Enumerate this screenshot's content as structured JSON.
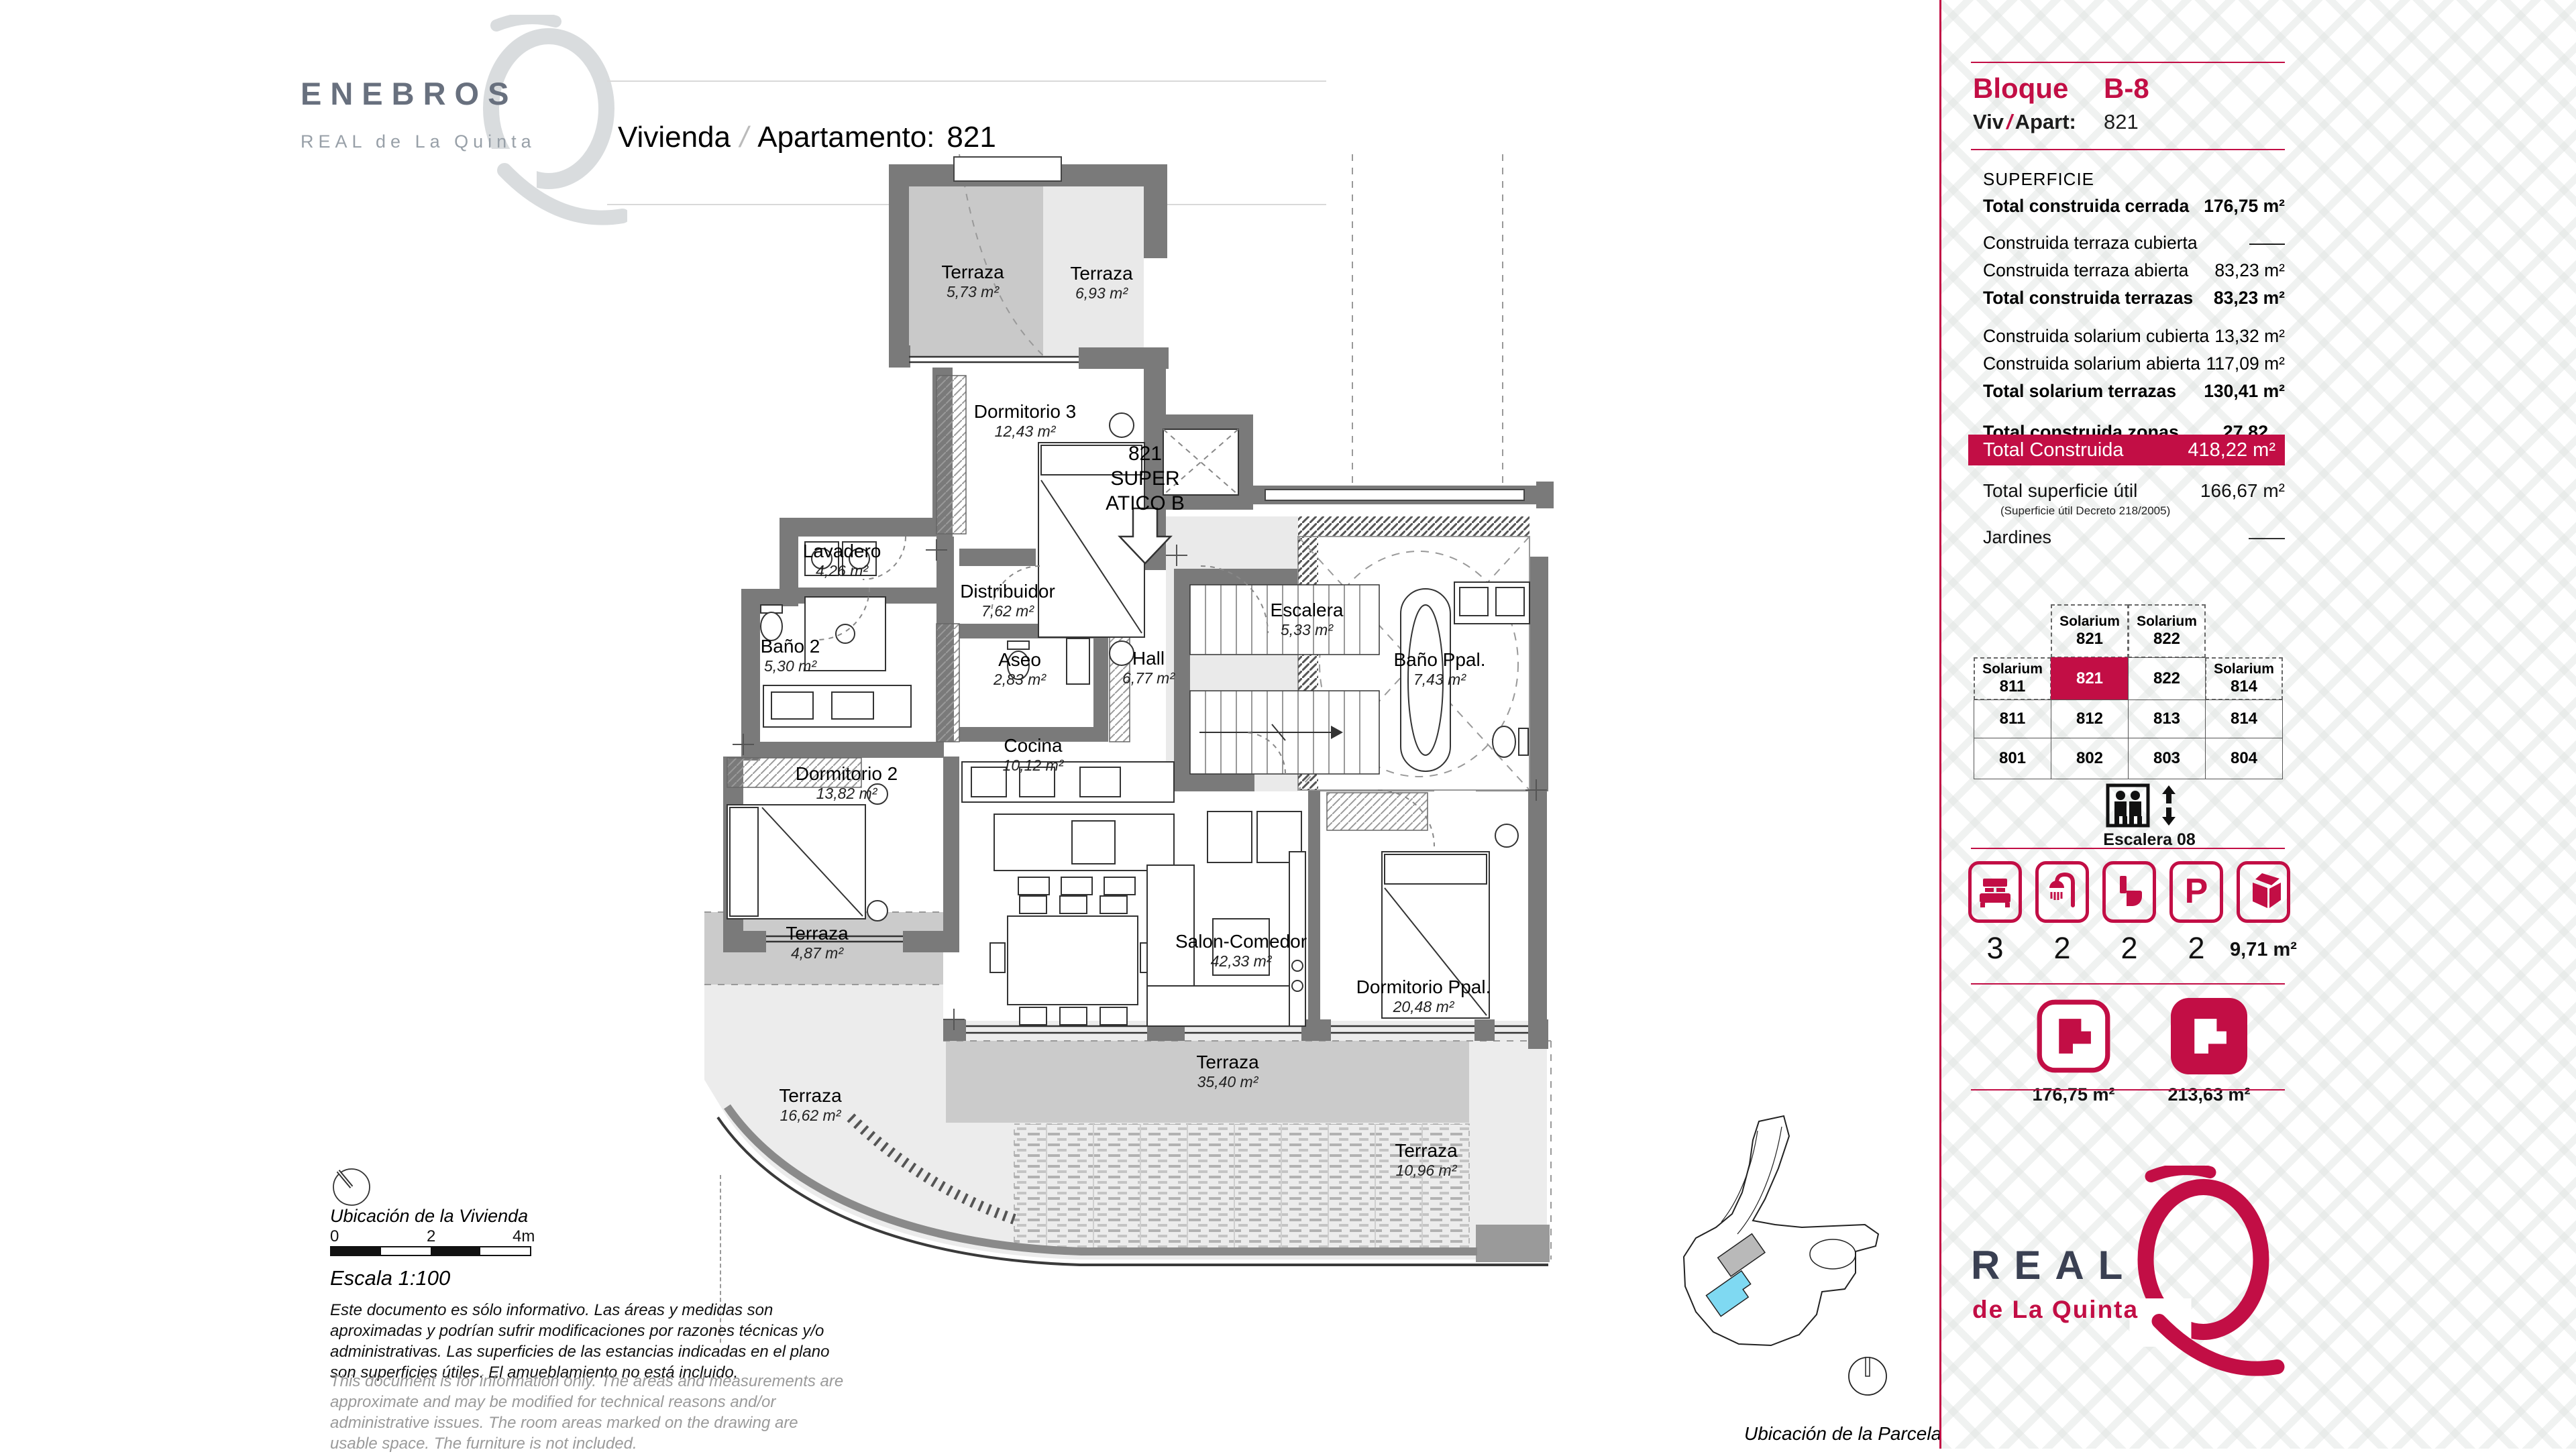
{
  "colors": {
    "accent": "#C20E45",
    "navy": "#3A4052",
    "slate": "#68707E",
    "cyan": "#7FD9F2"
  },
  "brand": {
    "name": "ENEBROS",
    "sub": "REAL de La Quinta"
  },
  "title": {
    "part1": "Vivienda",
    "sep": "/",
    "part2": "Apartamento:",
    "number": "821"
  },
  "plan": {
    "atico": {
      "line1": "821",
      "line2": "SUPER",
      "line3": "ATICO B"
    },
    "rooms": [
      {
        "id": "terraza_573",
        "name": "Terraza",
        "area": "5,73 m²"
      },
      {
        "id": "terraza_693",
        "name": "Terraza",
        "area": "6,93 m²"
      },
      {
        "id": "dormitorio3",
        "name": "Dormitorio 3",
        "area": "12,43 m²"
      },
      {
        "id": "lavadero",
        "name": "Lavadero",
        "area": "4,26 m²"
      },
      {
        "id": "distribuidor",
        "name": "Distribuidor",
        "area": "7,62 m²"
      },
      {
        "id": "bano2",
        "name": "Baño 2",
        "area": "5,30 m²"
      },
      {
        "id": "aseo",
        "name": "Aseo",
        "area": "2,83 m²"
      },
      {
        "id": "hall",
        "name": "Hall",
        "area": "6,77 m²"
      },
      {
        "id": "escalera",
        "name": "Escalera",
        "area": "5,33 m²"
      },
      {
        "id": "bano_ppal",
        "name": "Baño Ppal.",
        "area": "7,43 m²"
      },
      {
        "id": "dormitorio2",
        "name": "Dormitorio 2",
        "area": "13,82 m²"
      },
      {
        "id": "cocina",
        "name": "Cocina",
        "area": "10,12 m²"
      },
      {
        "id": "salon",
        "name": "Salon-Comedor",
        "area": "42,33 m²"
      },
      {
        "id": "dormitorio_ppal",
        "name": "Dormitorio Ppal.",
        "area": "20,48 m²"
      },
      {
        "id": "terraza_487",
        "name": "Terraza",
        "area": "4,87 m²"
      },
      {
        "id": "terraza_1662",
        "name": "Terraza",
        "area": "16,62 m²"
      },
      {
        "id": "terraza_3540",
        "name": "Terraza",
        "area": "35,40 m²"
      },
      {
        "id": "terraza_1096",
        "name": "Terraza",
        "area": "10,96 m²"
      }
    ]
  },
  "legend": {
    "location_home": "Ubicación de la Vivienda",
    "scale_ticks": [
      "0",
      "2",
      "4m"
    ],
    "scale_label": "Escala 1:100",
    "disclaimer_es": "Este documento es sólo informativo. Las áreas y medidas son aproximadas y podrían sufrir modificaciones por razones técnicas y/o administrativas. Las superficies de las estancias indicadas en el plano son superficies útiles. El amueblamiento no está incluido.",
    "disclaimer_en": "This document is for information only. The areas and measurements are approximate and may be modified for technical reasons and/or administrative issues. The room areas marked on the drawing are usable space. The furniture is not included.",
    "location_parcel": "Ubicación de la Parcela"
  },
  "sidebar": {
    "block_label": "Bloque",
    "block_value": "B-8",
    "unit_label_a": "Viv",
    "unit_slash": "/",
    "unit_label_b": "Apart:",
    "unit_value": "821",
    "superficie_title": "SUPERFICIE",
    "rows": [
      {
        "label": "Total construida cerrada",
        "value": "176,75 m²",
        "bold": true
      },
      {
        "label": "Construida terraza cubierta",
        "value": "——",
        "bold": false
      },
      {
        "label": "Construida terraza abierta",
        "value": "83,23 m²",
        "bold": false
      },
      {
        "label": "Total construida terrazas",
        "value": "83,23 m²",
        "bold": true
      },
      {
        "label": "Construida solarium cubierta",
        "value": "13,32 m²",
        "bold": false
      },
      {
        "label": "Construida solarium abierta",
        "value": "117,09 m²",
        "bold": false
      },
      {
        "label": "Total solarium terrazas",
        "value": "130,41 m²",
        "bold": true
      },
      {
        "label": "Total construida zonas comunes",
        "value": "27,82 m²",
        "bold": true
      }
    ],
    "total_row": {
      "label": "Total Construida",
      "value": "418,22 m²"
    },
    "util_row": {
      "label": "Total superficie útil",
      "value": "166,67 m²",
      "note": "(Superficie útil Decreto 218/2005)"
    },
    "jardines_row": {
      "label": "Jardines",
      "value": "——"
    },
    "grid": {
      "rows": [
        [
          {
            "type": "empty"
          },
          {
            "type": "dashed",
            "top": "Solarium",
            "num": "821"
          },
          {
            "type": "dashed",
            "top": "Solarium",
            "num": "822"
          },
          {
            "type": "empty"
          }
        ],
        [
          {
            "type": "dashed",
            "top": "Solarium",
            "num": "811"
          },
          {
            "type": "highlight",
            "num": "821"
          },
          {
            "type": "solid",
            "num": "822"
          },
          {
            "type": "dashed",
            "top": "Solarium",
            "num": "814"
          }
        ],
        [
          {
            "type": "solid",
            "num": "811"
          },
          {
            "type": "solid",
            "num": "812"
          },
          {
            "type": "solid",
            "num": "813"
          },
          {
            "type": "solid",
            "num": "814"
          }
        ],
        [
          {
            "type": "solid",
            "num": "801"
          },
          {
            "type": "solid",
            "num": "802"
          },
          {
            "type": "solid",
            "num": "803"
          },
          {
            "type": "solid",
            "num": "804"
          }
        ]
      ]
    },
    "stairs_label": "Escalera 08",
    "features": [
      {
        "icon": "bed-icon",
        "value": "3"
      },
      {
        "icon": "shower-icon",
        "value": "2"
      },
      {
        "icon": "toilet-icon",
        "value": "2"
      },
      {
        "icon": "parking-icon",
        "value": "2"
      },
      {
        "icon": "storage-icon",
        "value": "9,71 m²"
      }
    ],
    "plan_icons": [
      {
        "style": "outline",
        "area": "176,75 m²"
      },
      {
        "style": "filled",
        "area": "213,63 m²"
      }
    ],
    "logo": {
      "line1": "REAL",
      "line2": "de La Quinta"
    }
  }
}
